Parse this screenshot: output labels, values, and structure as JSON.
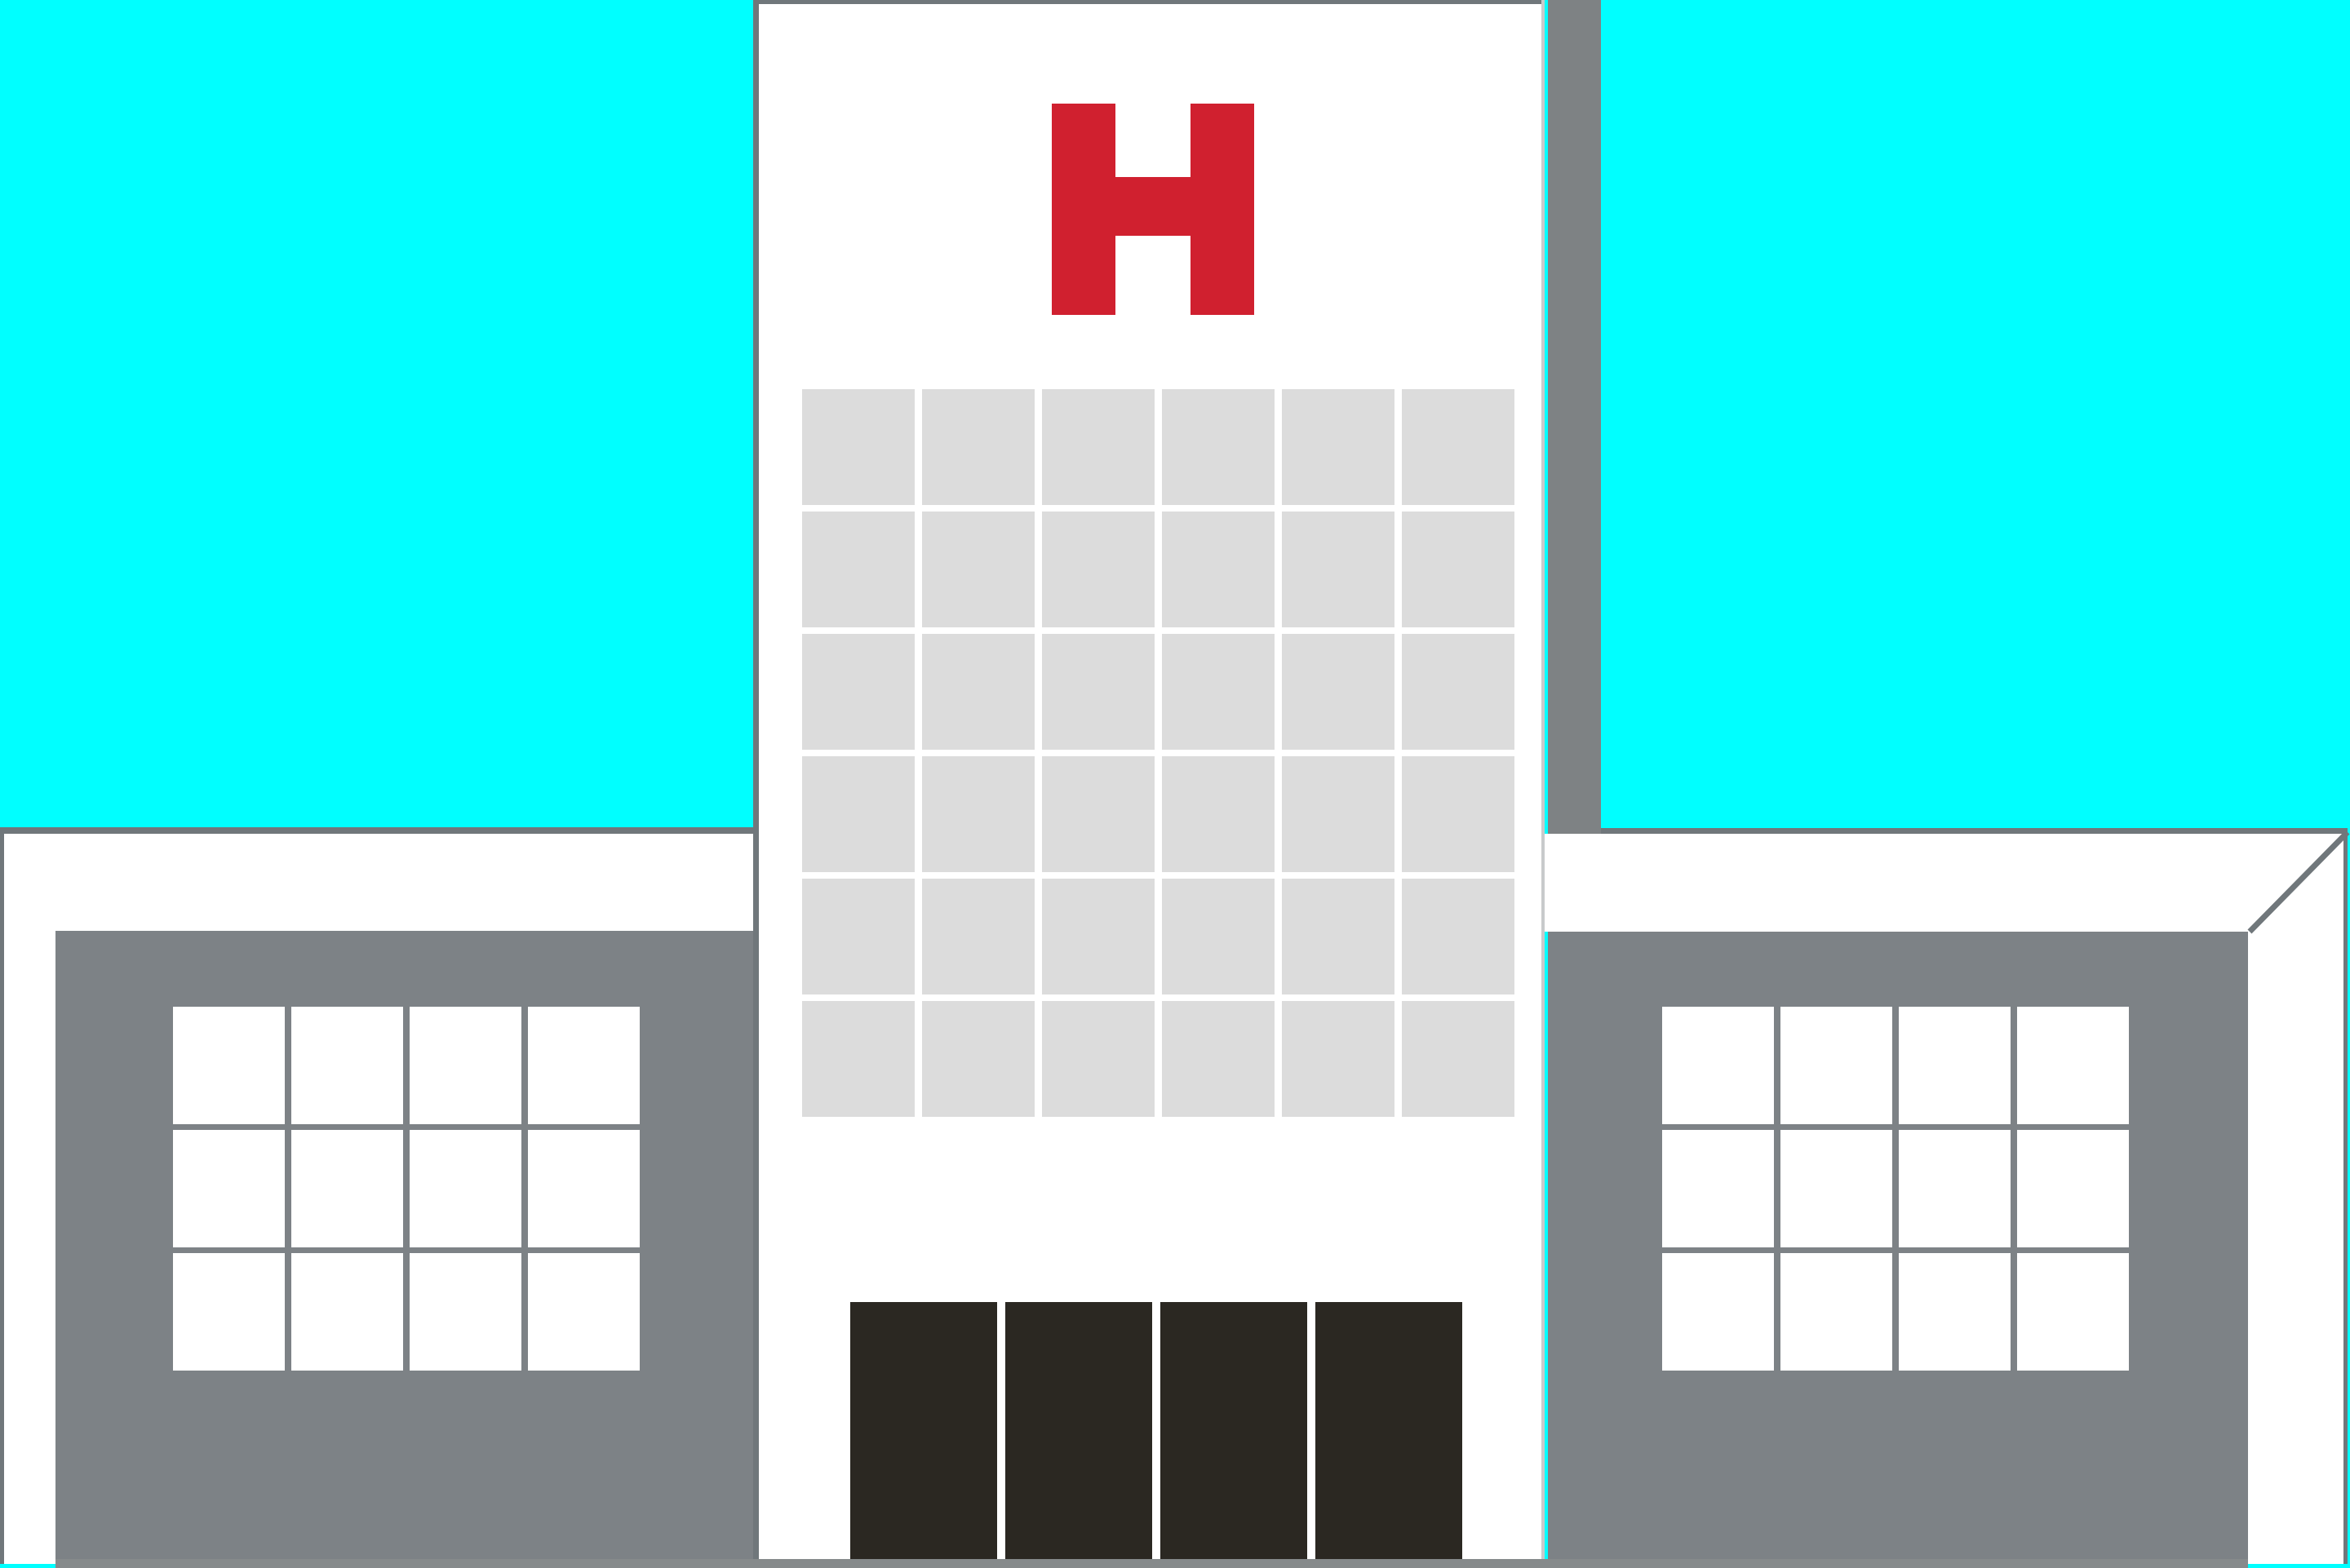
{
  "scene": {
    "description": "Flat illustration of a hospital building: cyan sky, white central tower with red H sign and gray window grid, two gray side wings with white multi-pane windows, four dark entrance doors",
    "sign_letter": "H",
    "colors": {
      "sky": "#00FFFF",
      "building_white": "#FFFFFF",
      "facade_gray": "#7D8286",
      "shadow_gray": "#7E8284",
      "outline_gray": "#70777B",
      "tower_window_gray": "#DCDCDC",
      "wing_pane_white": "#FFFFFF",
      "door_dark": "#2B2822",
      "sign_red": "#D0202F",
      "ground_gray": "#868A8B",
      "tower_edge_highlight": "#C8CACB"
    },
    "tower": {
      "window_grid": {
        "cols": 6,
        "rows": 6
      },
      "door_count": 4
    },
    "left_wing": {
      "window_grid": {
        "cols": 4,
        "rows": 3
      }
    },
    "right_wing": {
      "window_grid": {
        "cols": 4,
        "rows": 3
      }
    }
  }
}
